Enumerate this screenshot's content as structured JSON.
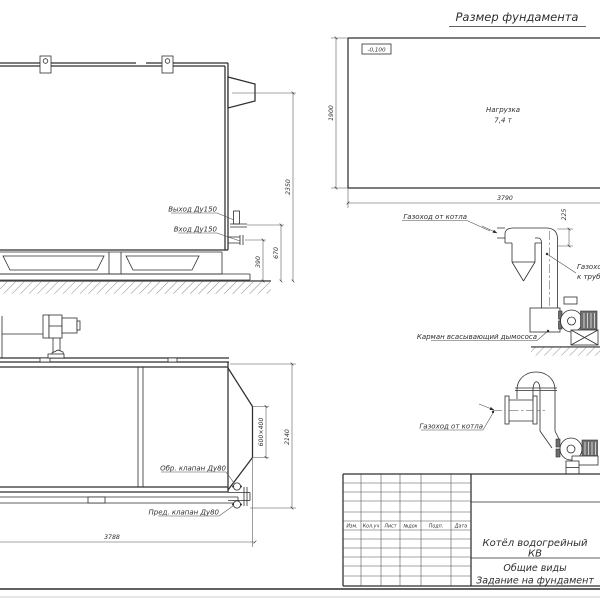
{
  "foundation": {
    "title": "Размер фундамента",
    "elevation_mark": "-0,100",
    "load_label": "Нагрузка",
    "load_value": "7,4 т",
    "width_dim": "3790",
    "height_dim": "1900"
  },
  "side_view": {
    "outlet_label": "Выход Ду150",
    "inlet_label": "Вход Ду150",
    "height_dim": "2350",
    "outlet_height_dim": "670",
    "inlet_height_dim": "390"
  },
  "plan_view": {
    "check_valve_label": "Обр. клапан Ду80",
    "safety_valve_label": "Пред. клапан Ду80",
    "length_dim": "3788",
    "width_dim": "2140",
    "flue_dim": "600×400"
  },
  "flue_upper": {
    "from_boiler_label": "Газоход от котла",
    "to_stack_label_1": "Газоход",
    "to_stack_label_2": "к трубе",
    "pocket_label": "Карман всасывающий дымососа",
    "offset_dim": "225"
  },
  "flue_lower": {
    "from_boiler_label": "Газоход от котла"
  },
  "title_block": {
    "col_izm": "Изм.",
    "col_kol": "Кол.уч",
    "col_list": "Лист",
    "col_doc": "№док",
    "col_podp": "Подп.",
    "col_data": "Дата",
    "product_line1": "Котёл водогрейный",
    "product_line2": "КВ",
    "doc_line1": "Общие виды",
    "doc_line2": "Задание на фундамент"
  }
}
